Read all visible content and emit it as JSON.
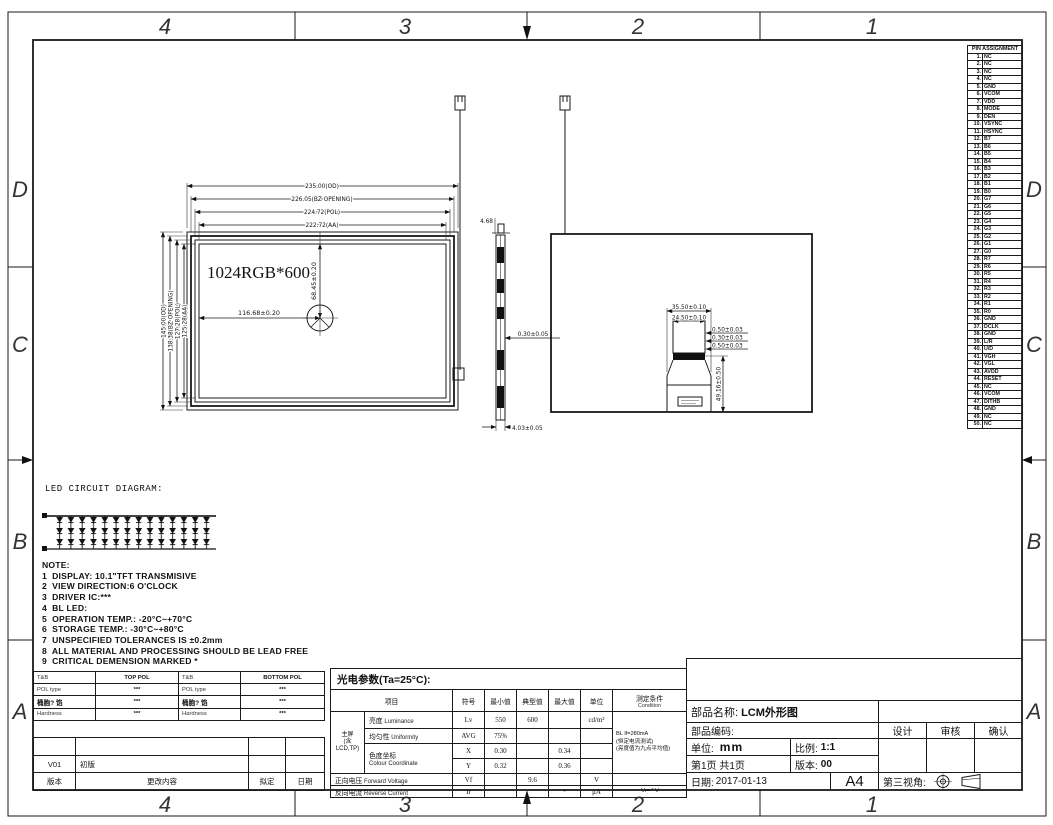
{
  "zones": {
    "cols": [
      "4",
      "3",
      "2",
      "1"
    ],
    "rows": [
      "D",
      "C",
      "B",
      "A"
    ]
  },
  "pin_table": {
    "title": "PIN ASSIGNMENT",
    "pins": [
      [
        "1.",
        "NC"
      ],
      [
        "2.",
        "NC"
      ],
      [
        "3.",
        "NC"
      ],
      [
        "4.",
        "NC"
      ],
      [
        "5.",
        "GND"
      ],
      [
        "6.",
        "VCOM"
      ],
      [
        "7.",
        "VDD"
      ],
      [
        "8.",
        "MODE"
      ],
      [
        "9.",
        "DEN"
      ],
      [
        "10.",
        "VSYNC"
      ],
      [
        "11.",
        "HSYNC"
      ],
      [
        "12.",
        "B7"
      ],
      [
        "13.",
        "B6"
      ],
      [
        "14.",
        "B5"
      ],
      [
        "15.",
        "B4"
      ],
      [
        "16.",
        "B3"
      ],
      [
        "17.",
        "B2"
      ],
      [
        "18.",
        "B1"
      ],
      [
        "19.",
        "B0"
      ],
      [
        "20.",
        "G7"
      ],
      [
        "21.",
        "G6"
      ],
      [
        "22.",
        "G5"
      ],
      [
        "23.",
        "G4"
      ],
      [
        "24.",
        "G3"
      ],
      [
        "25.",
        "G2"
      ],
      [
        "26.",
        "G1"
      ],
      [
        "27.",
        "G0"
      ],
      [
        "28.",
        "R7"
      ],
      [
        "29.",
        "R6"
      ],
      [
        "30.",
        "R5"
      ],
      [
        "31.",
        "R4"
      ],
      [
        "32.",
        "R3"
      ],
      [
        "33.",
        "R2"
      ],
      [
        "34.",
        "R1"
      ],
      [
        "35.",
        "R0"
      ],
      [
        "36.",
        "GND"
      ],
      [
        "37.",
        "DCLK"
      ],
      [
        "38.",
        "GND"
      ],
      [
        "39.",
        "L/R"
      ],
      [
        "40.",
        "U/D"
      ],
      [
        "41.",
        "VGH"
      ],
      [
        "42.",
        "VGL"
      ],
      [
        "43.",
        "AVDD"
      ],
      [
        "44.",
        "RESET"
      ],
      [
        "45.",
        "NC"
      ],
      [
        "46.",
        "VCOM"
      ],
      [
        "47.",
        "DITHB"
      ],
      [
        "48.",
        "GND"
      ],
      [
        "49.",
        "NC"
      ],
      [
        "50.",
        "NC"
      ]
    ]
  },
  "drawing": {
    "front": {
      "label": "1024RGB*600",
      "dim_od_w": "235.00(OD)",
      "dim_bz_w": "226.05(BZ OPENING)",
      "dim_pol_w": "224.72(POL)",
      "dim_aa_w": "222.72(AA)",
      "dim_od_h": "145.00(OD)",
      "dim_bz_h": "138.38(BZ OPENING)",
      "dim_pol_h": "127.28(POL)",
      "dim_aa_h": "125.28(AA)",
      "dim_cx": "116.68±0.20",
      "dim_cy": "68.45±0.20"
    },
    "side": {
      "dim_top": "4.68",
      "dim_mid": "0.30±0.05",
      "dim_bot": "4.03±0.05"
    },
    "back": {
      "dim_w1": "35.50±0.10",
      "dim_w2": "24.50±0.10",
      "dim_t1": "0.50±0.03",
      "dim_t2": "0.30±0.03",
      "dim_t3": "0.50±0.03",
      "dim_h": "49.16±0.50"
    },
    "led_title": "LED CIRCUIT DIAGRAM:"
  },
  "notes": {
    "title": "NOTE:",
    "lines": [
      "1  DISPLAY: 10.1\"TFT TRANSMISIVE",
      "2  VIEW DIRECTION:6 O'CLOCK",
      "3  DRIVER IC:***",
      "4  BL LED:",
      "5  OPERATION TEMP.: -20°C~+70°C",
      "6  STORAGE TEMP.: -30°C~+80°C",
      "7  UNSPECIFIED TOLERANCES IS ±0.2mm",
      "8  ALL MATERIAL AND PROCESSING SHOULD BE LEAD FREE",
      "9  CRITICAL DEMENSION MARKED *"
    ]
  },
  "pol_table": {
    "rows": [
      [
        "T&B",
        "TOP POL",
        "T&B",
        "BOTTOM POL"
      ],
      [
        "POL type",
        "***",
        "POL type",
        "***"
      ],
      [
        "桶胞? 馅",
        "***",
        "桶胞? 馅",
        "***"
      ],
      [
        "Hardness",
        "***",
        "Hardness",
        "***"
      ]
    ]
  },
  "revision_table": {
    "rows": [
      [
        "",
        "",
        "",
        ""
      ],
      [
        "V01",
        "初版",
        "",
        ""
      ],
      [
        "版本",
        "更改内容",
        "拟定",
        "日期"
      ]
    ]
  },
  "optical_table": {
    "title": "光电参数(Ta=25°C):",
    "headers": {
      "item": "项目",
      "symbol": "符号",
      "min": "最小值",
      "typ": "典型值",
      "max": "最大值",
      "unit": "单位",
      "cond": "测定条件",
      "cond2": "Condition"
    },
    "group": [
      "主屏",
      "(含",
      "LCD,TP)"
    ],
    "rows": {
      "lum": {
        "cn": "亮度",
        "en": "Luminance",
        "sym": "Lv",
        "min": "550",
        "typ": "600",
        "max": "",
        "unit": "cd/m²"
      },
      "uni": {
        "cn": "均匀性",
        "en": "Uniformity",
        "sym": "AVG",
        "min": "75%",
        "typ": "",
        "max": "",
        "unit": ""
      },
      "col": {
        "cn": "色度坐标",
        "en": "Colour Coordinate"
      },
      "x": {
        "sym": "X",
        "min": "0.30",
        "typ": "",
        "max": "0.34",
        "unit": ""
      },
      "y": {
        "sym": "Y",
        "min": "0.32",
        "typ": "",
        "max": "0.36",
        "unit": ""
      },
      "vf": {
        "cn": "正向电压",
        "en": "Forward Voltage",
        "sym": "Vf",
        "min": "",
        "typ": "9.6",
        "max": "",
        "unit": "V",
        "cond": ""
      },
      "ir": {
        "cn": "反向电流",
        "en": "Reverse Current",
        "sym": "Ir",
        "min": "",
        "typ": "",
        "max": "*",
        "unit": "μA",
        "cond": "Vr= * V"
      }
    },
    "condition": [
      "BL If=280mA",
      "(恒定电流测试)",
      "(亮度值为九点平均值)"
    ]
  },
  "title_block": {
    "part_name_label": "部品名称:",
    "part_name": "LCM外形图",
    "part_code_label": "部品编码:",
    "unit_label": "单位:",
    "unit": "mm",
    "scale_label": "比例:",
    "scale": "1:1",
    "page": "第1页 共1页",
    "version_label": "版本:",
    "version": "00",
    "date_label": "日期:",
    "date": "2017-01-13",
    "paper": "A4",
    "design": "设计",
    "review": "审核",
    "confirm": "确认",
    "projection_label": "第三视角:"
  }
}
